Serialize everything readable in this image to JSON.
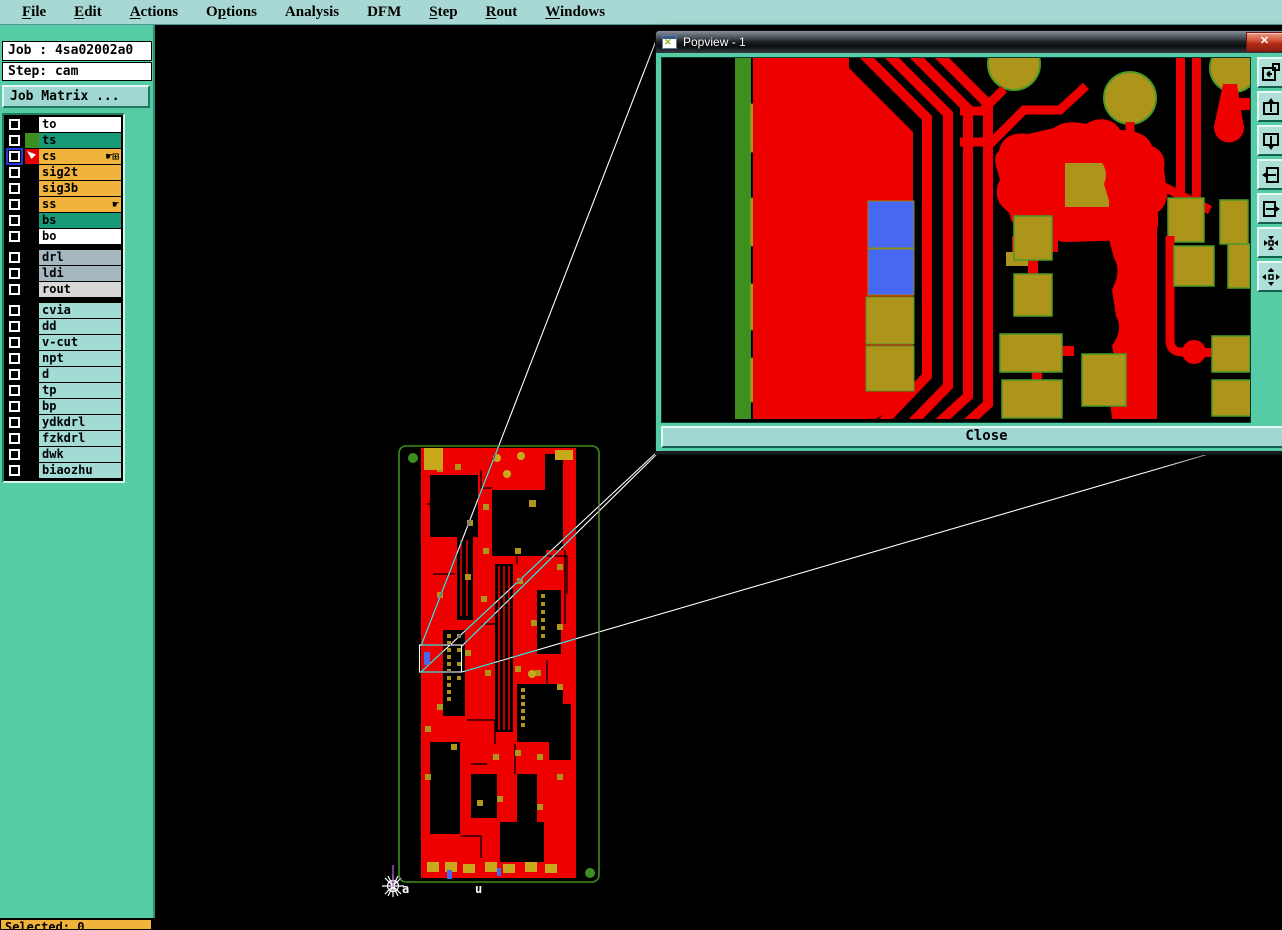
{
  "menu": {
    "items": [
      {
        "label": "File",
        "mnemonic_index": 0
      },
      {
        "label": "Edit",
        "mnemonic_index": 0
      },
      {
        "label": "Actions",
        "mnemonic_index": 0
      },
      {
        "label": "Options",
        "mnemonic_index": 1
      },
      {
        "label": "Analysis",
        "mnemonic_index": -1
      },
      {
        "label": "DFM",
        "mnemonic_index": -1
      },
      {
        "label": "Step",
        "mnemonic_index": 0
      },
      {
        "label": "Rout",
        "mnemonic_index": 0
      },
      {
        "label": "Windows",
        "mnemonic_index": 0
      }
    ]
  },
  "sidebar": {
    "job_line": "Job : 4sa02002a0",
    "step_line": "Step: cam",
    "job_matrix_button": "Job Matrix ...",
    "layer_groups": [
      {
        "layers": [
          {
            "name": "to",
            "row_color": "#ffffff",
            "swatch": "#000000"
          },
          {
            "name": "ts",
            "row_color": "#189a78",
            "swatch": "#3d8f1e"
          },
          {
            "name": "cs",
            "row_color": "#f0b43c",
            "swatch": "#e00000",
            "cursor_arrow": true,
            "blue_box": true,
            "right_icons": [
              "hand",
              "grid"
            ]
          },
          {
            "name": "sig2t",
            "row_color": "#f0b43c",
            "swatch": "#000000"
          },
          {
            "name": "sig3b",
            "row_color": "#f0b43c",
            "swatch": "#000000"
          },
          {
            "name": "ss",
            "row_color": "#f0b43c",
            "swatch": "#000000",
            "right_icons": [
              "hand"
            ]
          },
          {
            "name": "bs",
            "row_color": "#189a78",
            "swatch": "#000000"
          },
          {
            "name": "bo",
            "row_color": "#ffffff",
            "swatch": "#000000"
          }
        ]
      },
      {
        "layers": [
          {
            "name": "drl",
            "row_color": "#a5b8bf",
            "swatch": "#000000"
          },
          {
            "name": "ldi",
            "row_color": "#a5b8bf",
            "swatch": "#000000"
          },
          {
            "name": "rout",
            "row_color": "#d8d8d8",
            "swatch": "#000000"
          }
        ]
      },
      {
        "layers": [
          {
            "name": "cvia",
            "row_color": "#a2dad4",
            "swatch": "#000000"
          },
          {
            "name": "dd",
            "row_color": "#a2dad4",
            "swatch": "#000000"
          },
          {
            "name": "v-cut",
            "row_color": "#a2dad4",
            "swatch": "#000000"
          },
          {
            "name": "npt",
            "row_color": "#a2dad4",
            "swatch": "#000000"
          },
          {
            "name": "d",
            "row_color": "#a2dad4",
            "swatch": "#000000"
          },
          {
            "name": "tp",
            "row_color": "#a2dad4",
            "swatch": "#000000"
          },
          {
            "name": "bp",
            "row_color": "#a2dad4",
            "swatch": "#000000"
          },
          {
            "name": "ydkdrl",
            "row_color": "#a2dad4",
            "swatch": "#000000"
          },
          {
            "name": "fzkdrl",
            "row_color": "#a2dad4",
            "swatch": "#000000"
          },
          {
            "name": "dwk",
            "row_color": "#a2dad4",
            "swatch": "#000000"
          },
          {
            "name": "biaozhu",
            "row_color": "#a2dad4",
            "swatch": "#000000"
          }
        ]
      }
    ]
  },
  "popview": {
    "title": "Popview - 1",
    "close_x": "✕",
    "close_button": "Close",
    "toolbar_icons": [
      "new-popview-icon",
      "pan-up-icon",
      "pan-down-icon",
      "pan-left-icon",
      "pan-right-icon",
      "zoom-center-icon",
      "zoom-out-icon"
    ]
  },
  "canvas": {
    "origin_label_a": "a",
    "origin_label_b": "u"
  },
  "status_bar": {
    "text": "Selected: 0"
  },
  "colors": {
    "copper_red": "#ee0000",
    "pad_gold": "#ad941a",
    "pad_gold_bright": "#c9a91c",
    "board_green": "#3d8f1e",
    "pad_outline_green": "#4a9a28",
    "highlight_blue": "#4668f2",
    "menu_bg": "#a8d8d3",
    "sidebar_bg": "#55cba6",
    "row_teal": "#189a78",
    "row_orange": "#f0b43c",
    "row_gray": "#a5b8bf",
    "row_light": "#d8d8d8",
    "row_cyan": "#a2dad4",
    "callout_white": "#ffffff",
    "canvas_bg": "#000000"
  }
}
